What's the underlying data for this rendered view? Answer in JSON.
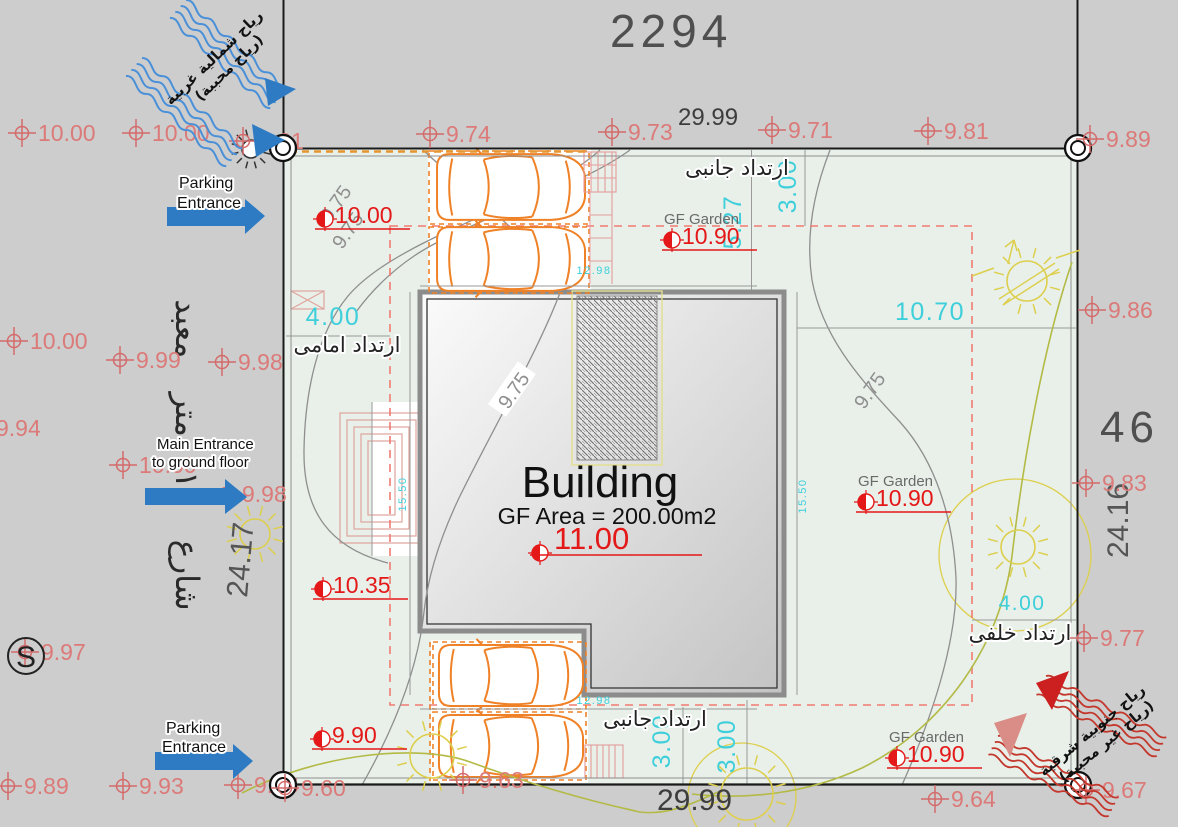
{
  "colors": {
    "street_bg": "#cdcdcd",
    "plot_bg": "#e8f0e9",
    "marker_red": "#d46a6a",
    "marker_text": "#db7a78",
    "spot_red": "#e41818",
    "cyan": "#3ecfdb",
    "orange": "#ef8126",
    "blue_arrow": "#2e7bc4",
    "wind_blue": "#4a90d9",
    "wind_red": "#c4372c",
    "yellow": "#ddcf4d",
    "olive": "#b3ba45",
    "contour_gray": "#8f8f8f",
    "dim_text": "#4f4f4f",
    "pink": "#e59c9c"
  },
  "dimensions": {
    "top_total": "2294",
    "top_frontage": "29.99",
    "bottom_frontage": "29.99",
    "right_total": "46",
    "right_depth": "24.16",
    "left_depth": "24.17"
  },
  "building": {
    "title": "Building",
    "area_label": "GF Area = 200.00m2"
  },
  "garden_label": "GF Garden",
  "annotations": {
    "parking_entrance_top": [
      "Parking",
      "Entrance"
    ],
    "main_entrance": [
      "Main Entrance",
      "to ground floor"
    ],
    "parking_entrance_bottom": [
      "Parking",
      "Entrance"
    ],
    "street_name_ar": "شارع ١٢ متر معبد",
    "setback_front_ar": "ارتداد امامى",
    "setback_side_top_ar": "ارتداد جانبى",
    "setback_side_bottom_ar": "ارتداد جانبى",
    "setback_rear_ar": "ارتداد خلفى",
    "wind_nw_ar": [
      "رياح شمالية غربية",
      "(رياح محببة)"
    ],
    "wind_se_ar": [
      "رياح جنوبية شرقية",
      "(رياح غير محببة)"
    ],
    "benchmark_symbol": "S"
  },
  "elevation_markers_outside": [
    {
      "x": 22,
      "y": 133,
      "v": "10.00"
    },
    {
      "x": 136,
      "y": 133,
      "v": "10.00"
    },
    {
      "x": 243,
      "y": 141,
      "v": "9.81"
    },
    {
      "x": 430,
      "y": 134,
      "v": "9.74"
    },
    {
      "x": 612,
      "y": 132,
      "v": "9.73"
    },
    {
      "x": 772,
      "y": 130,
      "v": "9.71"
    },
    {
      "x": 928,
      "y": 131,
      "v": "9.81"
    },
    {
      "x": 14,
      "y": 341,
      "v": "10.00"
    },
    {
      "x": -20,
      "y": 428,
      "v": "9.94"
    },
    {
      "x": 120,
      "y": 360,
      "v": "9.99"
    },
    {
      "x": 222,
      "y": 362,
      "v": "9.98"
    },
    {
      "x": 123,
      "y": 465,
      "v": "10.00"
    },
    {
      "x": 226,
      "y": 494,
      "v": "9.98"
    },
    {
      "x": 25,
      "y": 652,
      "v": "9.97"
    },
    {
      "x": 8,
      "y": 786,
      "v": "9.89"
    },
    {
      "x": 123,
      "y": 786,
      "v": "9.93"
    },
    {
      "x": 238,
      "y": 785,
      "v": "9.96"
    },
    {
      "x": 463,
      "y": 780,
      "v": "9.63"
    },
    {
      "x": 935,
      "y": 799,
      "v": "9.64"
    },
    {
      "x": 1092,
      "y": 310,
      "v": "9.86"
    },
    {
      "x": 1086,
      "y": 483,
      "v": "9.83"
    },
    {
      "x": 1084,
      "y": 638,
      "v": "9.77"
    }
  ],
  "elevation_markers_above": [
    {
      "x": 1090,
      "y": 139,
      "v": "9.89"
    },
    {
      "x": 285,
      "y": 788,
      "v": "9.60"
    },
    {
      "x": 1086,
      "y": 790,
      "v": "9.67"
    }
  ],
  "corner_monuments": [
    {
      "x": 283,
      "y": 148
    },
    {
      "x": 1078,
      "y": 148
    },
    {
      "x": 283,
      "y": 785
    },
    {
      "x": 1078,
      "y": 785
    }
  ],
  "spot_levels": [
    {
      "x": 325,
      "y": 219,
      "v": "10.00"
    },
    {
      "x": 540,
      "y": 553,
      "v": "11.00",
      "big": true
    },
    {
      "x": 323,
      "y": 589,
      "v": "10.35"
    },
    {
      "x": 322,
      "y": 739,
      "v": "9.90"
    },
    {
      "x": 672,
      "y": 240,
      "v": "10.90",
      "garden": true
    },
    {
      "x": 866,
      "y": 502,
      "v": "10.90",
      "garden": true
    },
    {
      "x": 897,
      "y": 758,
      "v": "10.90",
      "garden": true
    }
  ],
  "cyan_dims": [
    {
      "x": 741,
      "y": 222,
      "v": "5.27",
      "rot": -90
    },
    {
      "x": 796,
      "y": 186,
      "v": "3.00",
      "rot": -90
    },
    {
      "x": 930,
      "y": 320,
      "v": "10.70"
    },
    {
      "x": 333,
      "y": 325,
      "v": "4.00"
    },
    {
      "x": 1022,
      "y": 610,
      "v": "4.00",
      "size": 21
    },
    {
      "x": 670,
      "y": 741,
      "v": "3.00",
      "rot": -90
    },
    {
      "x": 735,
      "y": 746,
      "v": "3.00",
      "rot": -90
    },
    {
      "x": 406,
      "y": 494,
      "v": "15.50",
      "rot": -90,
      "size": 11
    },
    {
      "x": 806,
      "y": 496,
      "v": "15.50",
      "rot": -90,
      "size": 11
    },
    {
      "x": 594,
      "y": 274,
      "v": "12.98",
      "size": 11
    },
    {
      "x": 594,
      "y": 704,
      "v": "12.98",
      "size": 11
    }
  ],
  "contour_labels": [
    {
      "x": 338,
      "y": 205,
      "v": "9.75",
      "rot": -55
    },
    {
      "x": 350,
      "y": 232,
      "v": "9.75",
      "rot": -55
    },
    {
      "x": 516,
      "y": 392,
      "v": "9.75",
      "rot": -55,
      "boxed": true
    },
    {
      "x": 872,
      "y": 392,
      "v": "9.75",
      "rot": -55
    }
  ],
  "suns": [
    {
      "x": 1027,
      "y": 281,
      "r": 20,
      "t": "slash"
    },
    {
      "x": 1018,
      "y": 547,
      "r": 17
    },
    {
      "x": 255,
      "y": 534,
      "r": 15
    },
    {
      "x": 432,
      "y": 756,
      "r": 22
    },
    {
      "x": 747,
      "y": 794,
      "r": 26
    },
    {
      "x": 251,
      "y": 149,
      "r": 9,
      "t": "white"
    }
  ],
  "cars": [
    {
      "x": 434,
      "y": 153,
      "w": 152,
      "h": 68
    },
    {
      "x": 434,
      "y": 226,
      "w": 152,
      "h": 66
    },
    {
      "x": 436,
      "y": 644,
      "w": 148,
      "h": 63
    },
    {
      "x": 436,
      "y": 714,
      "w": 148,
      "h": 64
    }
  ]
}
